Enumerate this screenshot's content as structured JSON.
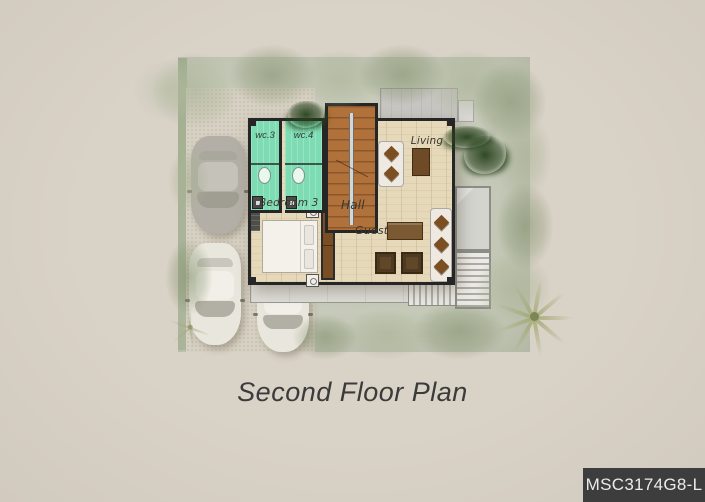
{
  "plan": {
    "title": "Second Floor Plan",
    "code": "MSC3174G8-L",
    "rooms": {
      "wc3": "wc.3",
      "wc4": "wc.4",
      "living": "Living",
      "bedroom3": "Bedroom 3",
      "hall": "Hall",
      "guest": "Guest"
    }
  },
  "colors": {
    "background": "#d9d2c7",
    "site_ground": "#c9ccbc",
    "driveway": "#d7d1c3",
    "wall": "#262626",
    "wood_floor": "#e6d9ba",
    "wc_floor": "#7edcb4",
    "stair_wood": "#b0713a",
    "terrace": "#c7c5c1",
    "car_gray": "#b3afa6",
    "car_white": "#e9e6dd",
    "foliage": "#7d8c67",
    "dark_shrub": "#2b441f",
    "furniture_brown": "#7b5a33",
    "chair_brown": "#4e3a22",
    "sofa_white": "#efeae1",
    "bed_white": "#f3f1ea",
    "title_text": "#3b3b3b",
    "code_bg": "#3d3d3d",
    "code_text": "#ebebeb"
  }
}
